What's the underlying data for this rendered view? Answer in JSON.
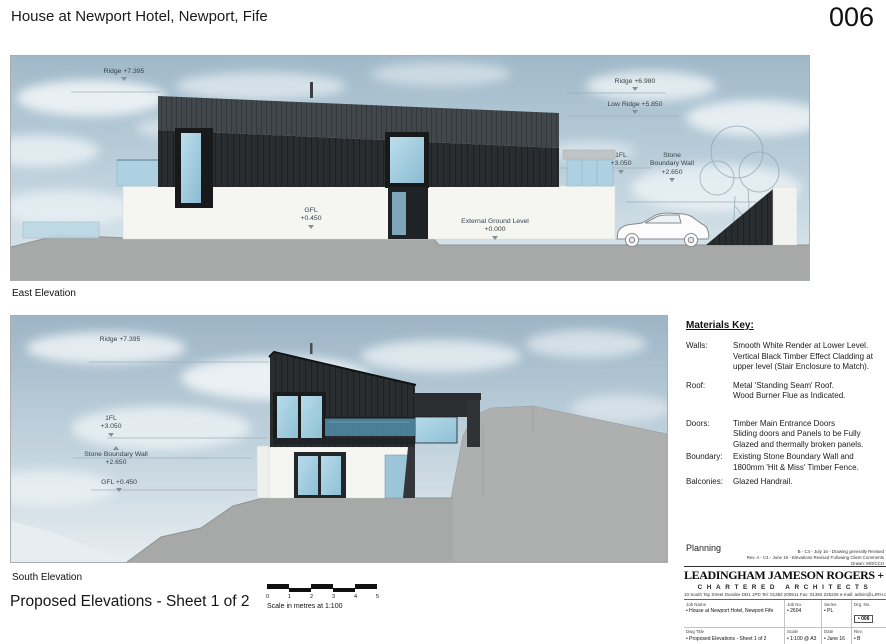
{
  "header": {
    "project_title": "House at Newport Hotel, Newport, Fife",
    "sheet_number": "006"
  },
  "east_elevation": {
    "caption": "East Elevation",
    "annotations": {
      "ridge_left": "Ridge +7.395",
      "ridge_right": "Ridge +6.980",
      "low_ridge": "Low Ridge +5.850",
      "first_floor": "1FL\n+3.050",
      "boundary_wall": "Stone\nBoundary Wall\n+2.650",
      "ground_floor": "GFL\n+0.450",
      "external_ground": "External Ground Level\n+0.000"
    }
  },
  "south_elevation": {
    "caption": "South Elevation",
    "annotations": {
      "ridge": "Ridge +7.395",
      "first_floor": "1FL\n+3.050",
      "boundary_wall": "Stone Boundary Wall\n+2.650",
      "ground_floor": "GFL +0.450"
    }
  },
  "materials_key": {
    "title": "Materials Key:",
    "items": [
      {
        "term": "Walls:",
        "desc": "Smooth White Render at Lower Level.\nVertical Black Timber Effect Cladding at\nupper level (Stair Enclosure to Match)."
      },
      {
        "term": "Roof:",
        "desc": "Metal 'Standing Seam' Roof.\nWood Burner Flue as Indicated."
      },
      {
        "term": "Doors:",
        "desc": "Timber Main Entrance Doors\nSliding doors and Panels to be Fully\nGlazed and thermally broken panels."
      },
      {
        "term": "Boundary:",
        "desc": "Existing Stone Boundary Wall and\n1800mm 'Hit & Miss' Timber Fence."
      },
      {
        "term": "Balconies:",
        "desc": "Glazed Handrail."
      }
    ]
  },
  "status": "Planning",
  "revisions": [
    "B - C4 - July 16 - Drawing generally Revised",
    "Rev. A - C4 - June 16 - Elevations Revised Following Client Comments",
    "Drawn:  MO/CCH"
  ],
  "sheet_title": "Proposed Elevations - Sheet 1 of 2",
  "scale_bar": {
    "ticks": [
      "0",
      "1",
      "2",
      "3",
      "4",
      "5"
    ],
    "caption": "Scale in metres at 1:100"
  },
  "title_block": {
    "firm_name": "LEADINGHAM JAMESON ROGERS + HYND",
    "firm_subtitle": "CHARTERED ARCHITECTS",
    "address": "10 South Tay Street Dundee DD1 1PD     Tel: 01382 200511     Fax: 01382 225226     e-mail: admin@LJRH.co.uk",
    "fields": [
      {
        "label": "Job Name",
        "value": "• House at Newport Hotel, Newport Fife"
      },
      {
        "label": "Job No.",
        "value": "• 2604"
      },
      {
        "label": "Series",
        "value": "• PL"
      },
      {
        "label": "Drg. No.",
        "value": "• 006"
      },
      {
        "label": "Dwg Title",
        "value": "• Proposed Elevations - Sheet 1 of 2"
      },
      {
        "label": "Scale",
        "value": "• 1:100 @ A3"
      },
      {
        "label": "Date",
        "value": "• June 16"
      },
      {
        "label": "Rev.",
        "value": "• B"
      }
    ]
  },
  "colors": {
    "cladding": "#2a2d2f",
    "roof": "#42474b",
    "render": "#f5f5f2",
    "glass": "#a5cde0",
    "balcony_glass": "#4e85a1",
    "ground": "#a7a9a8",
    "sky": "#b4c9d6"
  }
}
